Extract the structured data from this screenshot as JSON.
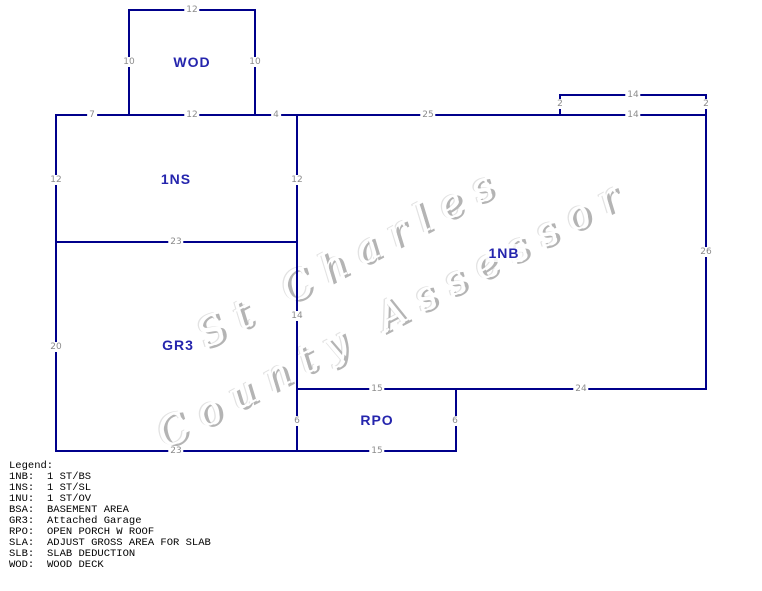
{
  "colors": {
    "background": "#ffffff",
    "wall": "#00008b",
    "area_label": "#2525ad",
    "dimension_text": "#8c8c8c",
    "watermark": "#b4b4b4",
    "legend_text": "#000000"
  },
  "watermark": {
    "line1": "St Charles",
    "line2": "County Assessor"
  },
  "areas": [
    {
      "code": "WOD",
      "x": 192,
      "y": 62
    },
    {
      "code": "1NS",
      "x": 176,
      "y": 179
    },
    {
      "code": "1NB",
      "x": 504,
      "y": 253
    },
    {
      "code": "GR3",
      "x": 178,
      "y": 345
    },
    {
      "code": "RPO",
      "x": 377,
      "y": 420
    }
  ],
  "walls": [
    {
      "name": "wod-top",
      "x": 128,
      "y": 9,
      "w": 128,
      "h": 2
    },
    {
      "name": "wod-left",
      "x": 128,
      "y": 9,
      "w": 2,
      "h": 107
    },
    {
      "name": "wod-right",
      "x": 254,
      "y": 9,
      "w": 2,
      "h": 107
    },
    {
      "name": "main-top",
      "x": 55,
      "y": 114,
      "w": 652,
      "h": 2
    },
    {
      "name": "bump-top",
      "x": 559,
      "y": 94,
      "w": 148,
      "h": 2
    },
    {
      "name": "bump-left",
      "x": 559,
      "y": 94,
      "w": 2,
      "h": 22
    },
    {
      "name": "right-edge",
      "x": 705,
      "y": 94,
      "w": 2,
      "h": 296
    },
    {
      "name": "left-edge",
      "x": 55,
      "y": 114,
      "w": 2,
      "h": 338
    },
    {
      "name": "center-divider",
      "x": 296,
      "y": 114,
      "w": 2,
      "h": 338
    },
    {
      "name": "1ns-bottom",
      "x": 55,
      "y": 241,
      "w": 243,
      "h": 2
    },
    {
      "name": "1nb-bottom",
      "x": 296,
      "y": 388,
      "w": 411,
      "h": 2
    },
    {
      "name": "outer-bottom",
      "x": 55,
      "y": 450,
      "w": 402,
      "h": 2
    },
    {
      "name": "rpo-right",
      "x": 455,
      "y": 388,
      "w": 2,
      "h": 64
    }
  ],
  "dimensions": [
    {
      "text": "12",
      "x": 192,
      "y": 10
    },
    {
      "text": "10",
      "x": 129,
      "y": 62
    },
    {
      "text": "10",
      "x": 255,
      "y": 62
    },
    {
      "text": "7",
      "x": 92,
      "y": 115
    },
    {
      "text": "12",
      "x": 192,
      "y": 115
    },
    {
      "text": "4",
      "x": 276,
      "y": 115
    },
    {
      "text": "25",
      "x": 428,
      "y": 115
    },
    {
      "text": "14",
      "x": 633,
      "y": 95
    },
    {
      "text": "2",
      "x": 560,
      "y": 104
    },
    {
      "text": "2",
      "x": 706,
      "y": 104
    },
    {
      "text": "14",
      "x": 633,
      "y": 115
    },
    {
      "text": "12",
      "x": 56,
      "y": 180
    },
    {
      "text": "12",
      "x": 297,
      "y": 180
    },
    {
      "text": "26",
      "x": 706,
      "y": 252
    },
    {
      "text": "23",
      "x": 176,
      "y": 242
    },
    {
      "text": "14",
      "x": 297,
      "y": 316
    },
    {
      "text": "20",
      "x": 56,
      "y": 347
    },
    {
      "text": "6",
      "x": 297,
      "y": 421
    },
    {
      "text": "6",
      "x": 455,
      "y": 421
    },
    {
      "text": "15",
      "x": 377,
      "y": 389
    },
    {
      "text": "24",
      "x": 581,
      "y": 389
    },
    {
      "text": "23",
      "x": 176,
      "y": 451
    },
    {
      "text": "15",
      "x": 377,
      "y": 451
    }
  ],
  "legend": {
    "title": "Legend:",
    "entries": [
      {
        "code": "1NB:",
        "desc": "1 ST/BS"
      },
      {
        "code": "1NS:",
        "desc": "1 ST/SL"
      },
      {
        "code": "1NU:",
        "desc": "1 ST/OV"
      },
      {
        "code": "BSA:",
        "desc": "BASEMENT AREA"
      },
      {
        "code": "GR3:",
        "desc": "Attached Garage"
      },
      {
        "code": "RPO:",
        "desc": "OPEN PORCH W ROOF"
      },
      {
        "code": "SLA:",
        "desc": "ADJUST GROSS AREA FOR SLAB"
      },
      {
        "code": "SLB:",
        "desc": "SLAB DEDUCTION"
      },
      {
        "code": "WOD:",
        "desc": "WOOD DECK"
      }
    ]
  }
}
